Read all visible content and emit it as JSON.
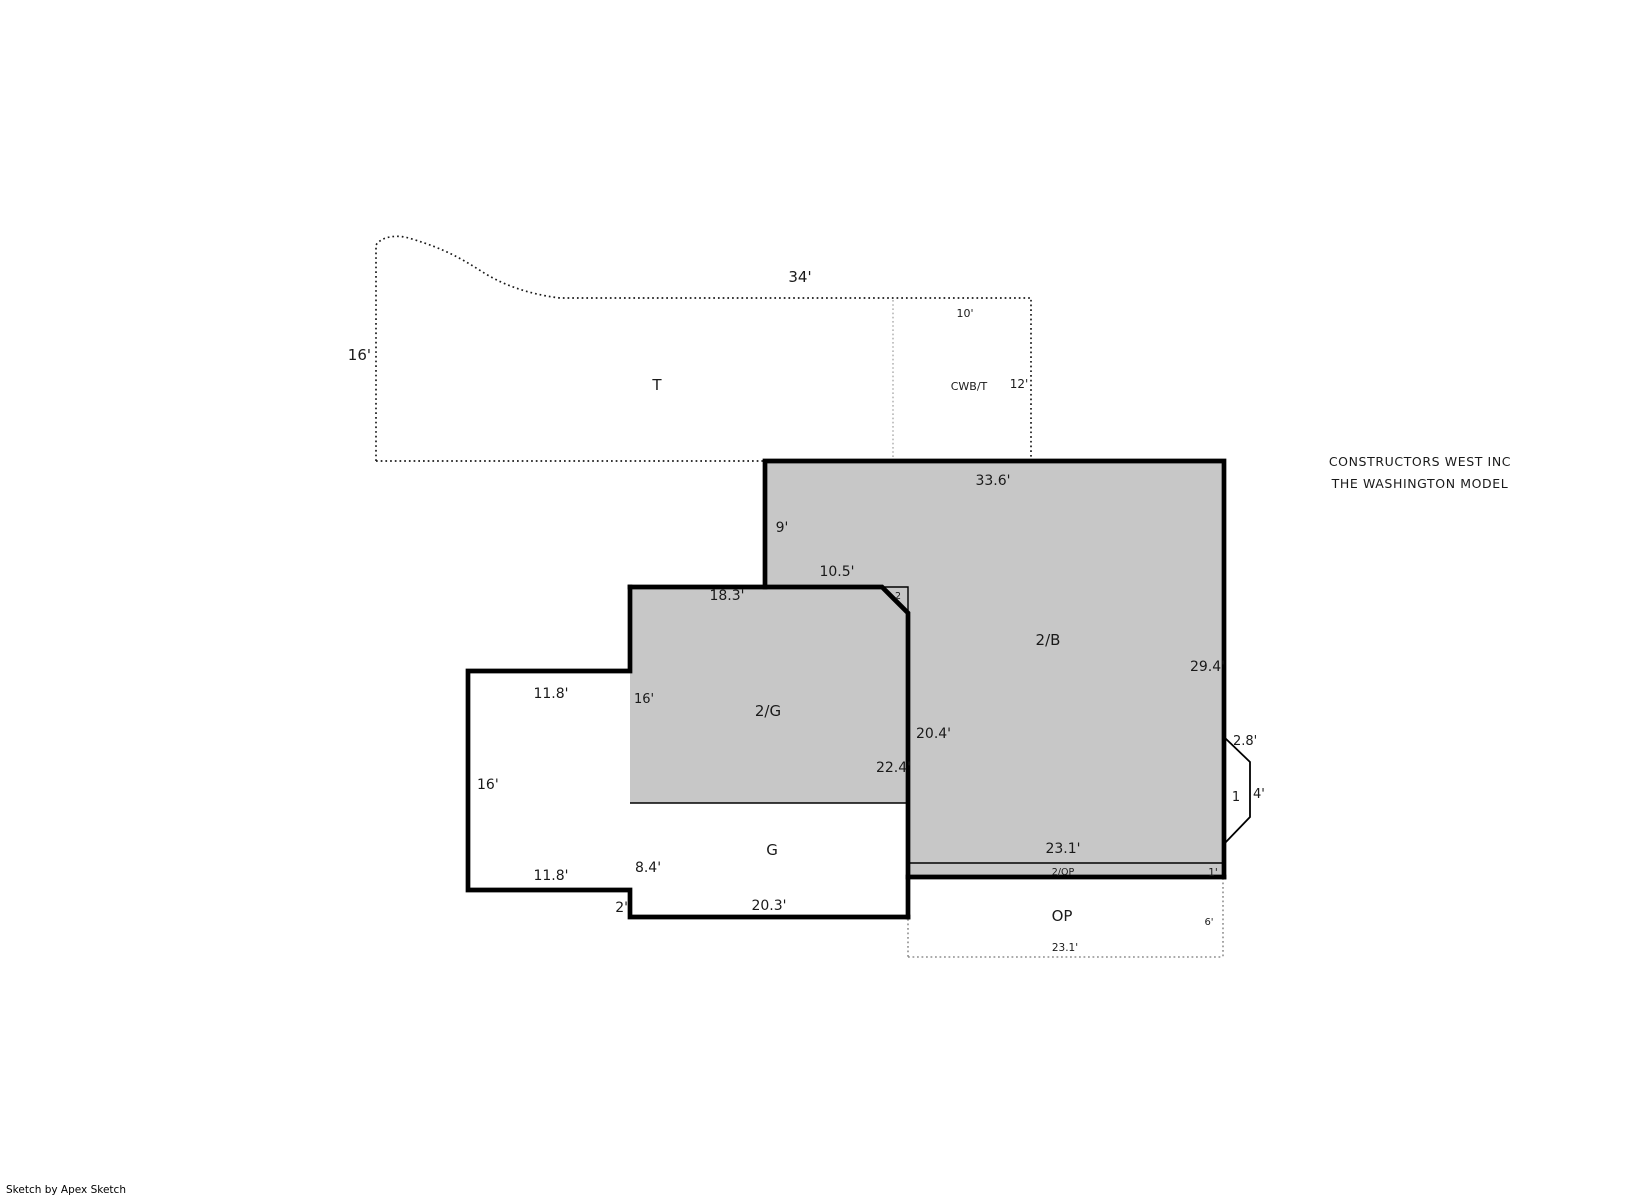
{
  "document": {
    "company_line1": "CONSTRUCTORS WEST INC",
    "company_line2": "THE WASHINGTON MODEL",
    "footer": "Sketch by Apex Sketch"
  },
  "colors": {
    "area_fill": "#c7c7c7",
    "outline": "#000000",
    "area_label_blue": "#2e5fa8",
    "company_blue": "#1e4fa0"
  },
  "areas": {
    "t": "T",
    "cwbt": "CWB/T",
    "b2": "2/B",
    "g2": "2/G",
    "g": "G",
    "op": "OP",
    "op2": "2/OP",
    "porch": "1",
    "corner": "2"
  },
  "dimensions": {
    "t_top": "34'",
    "t_left": "16'",
    "cwbt_top": "10'",
    "cwbt_right": "12'",
    "b2_top": "33.6'",
    "b2_notch_vertical": "9'",
    "b2_notch_horizontal": "10.5'",
    "b2_right": "29.4'",
    "b2_left": "20.4'",
    "b2_bottom": "23.1'",
    "g2_top": "18.3'",
    "g2_height": "16'",
    "g_wing_top": "11.8'",
    "g_wing_left": "16'",
    "g_wing_bottom": "11.8'",
    "g_right": "22.4'",
    "g_lower_height": "8.4'",
    "g_step": "2'",
    "g_bottom": "20.3'",
    "porch_top": "2.8'",
    "porch_right": "4'",
    "op2_right": "1'",
    "op_right": "6'",
    "op_bottom": "23.1'"
  }
}
